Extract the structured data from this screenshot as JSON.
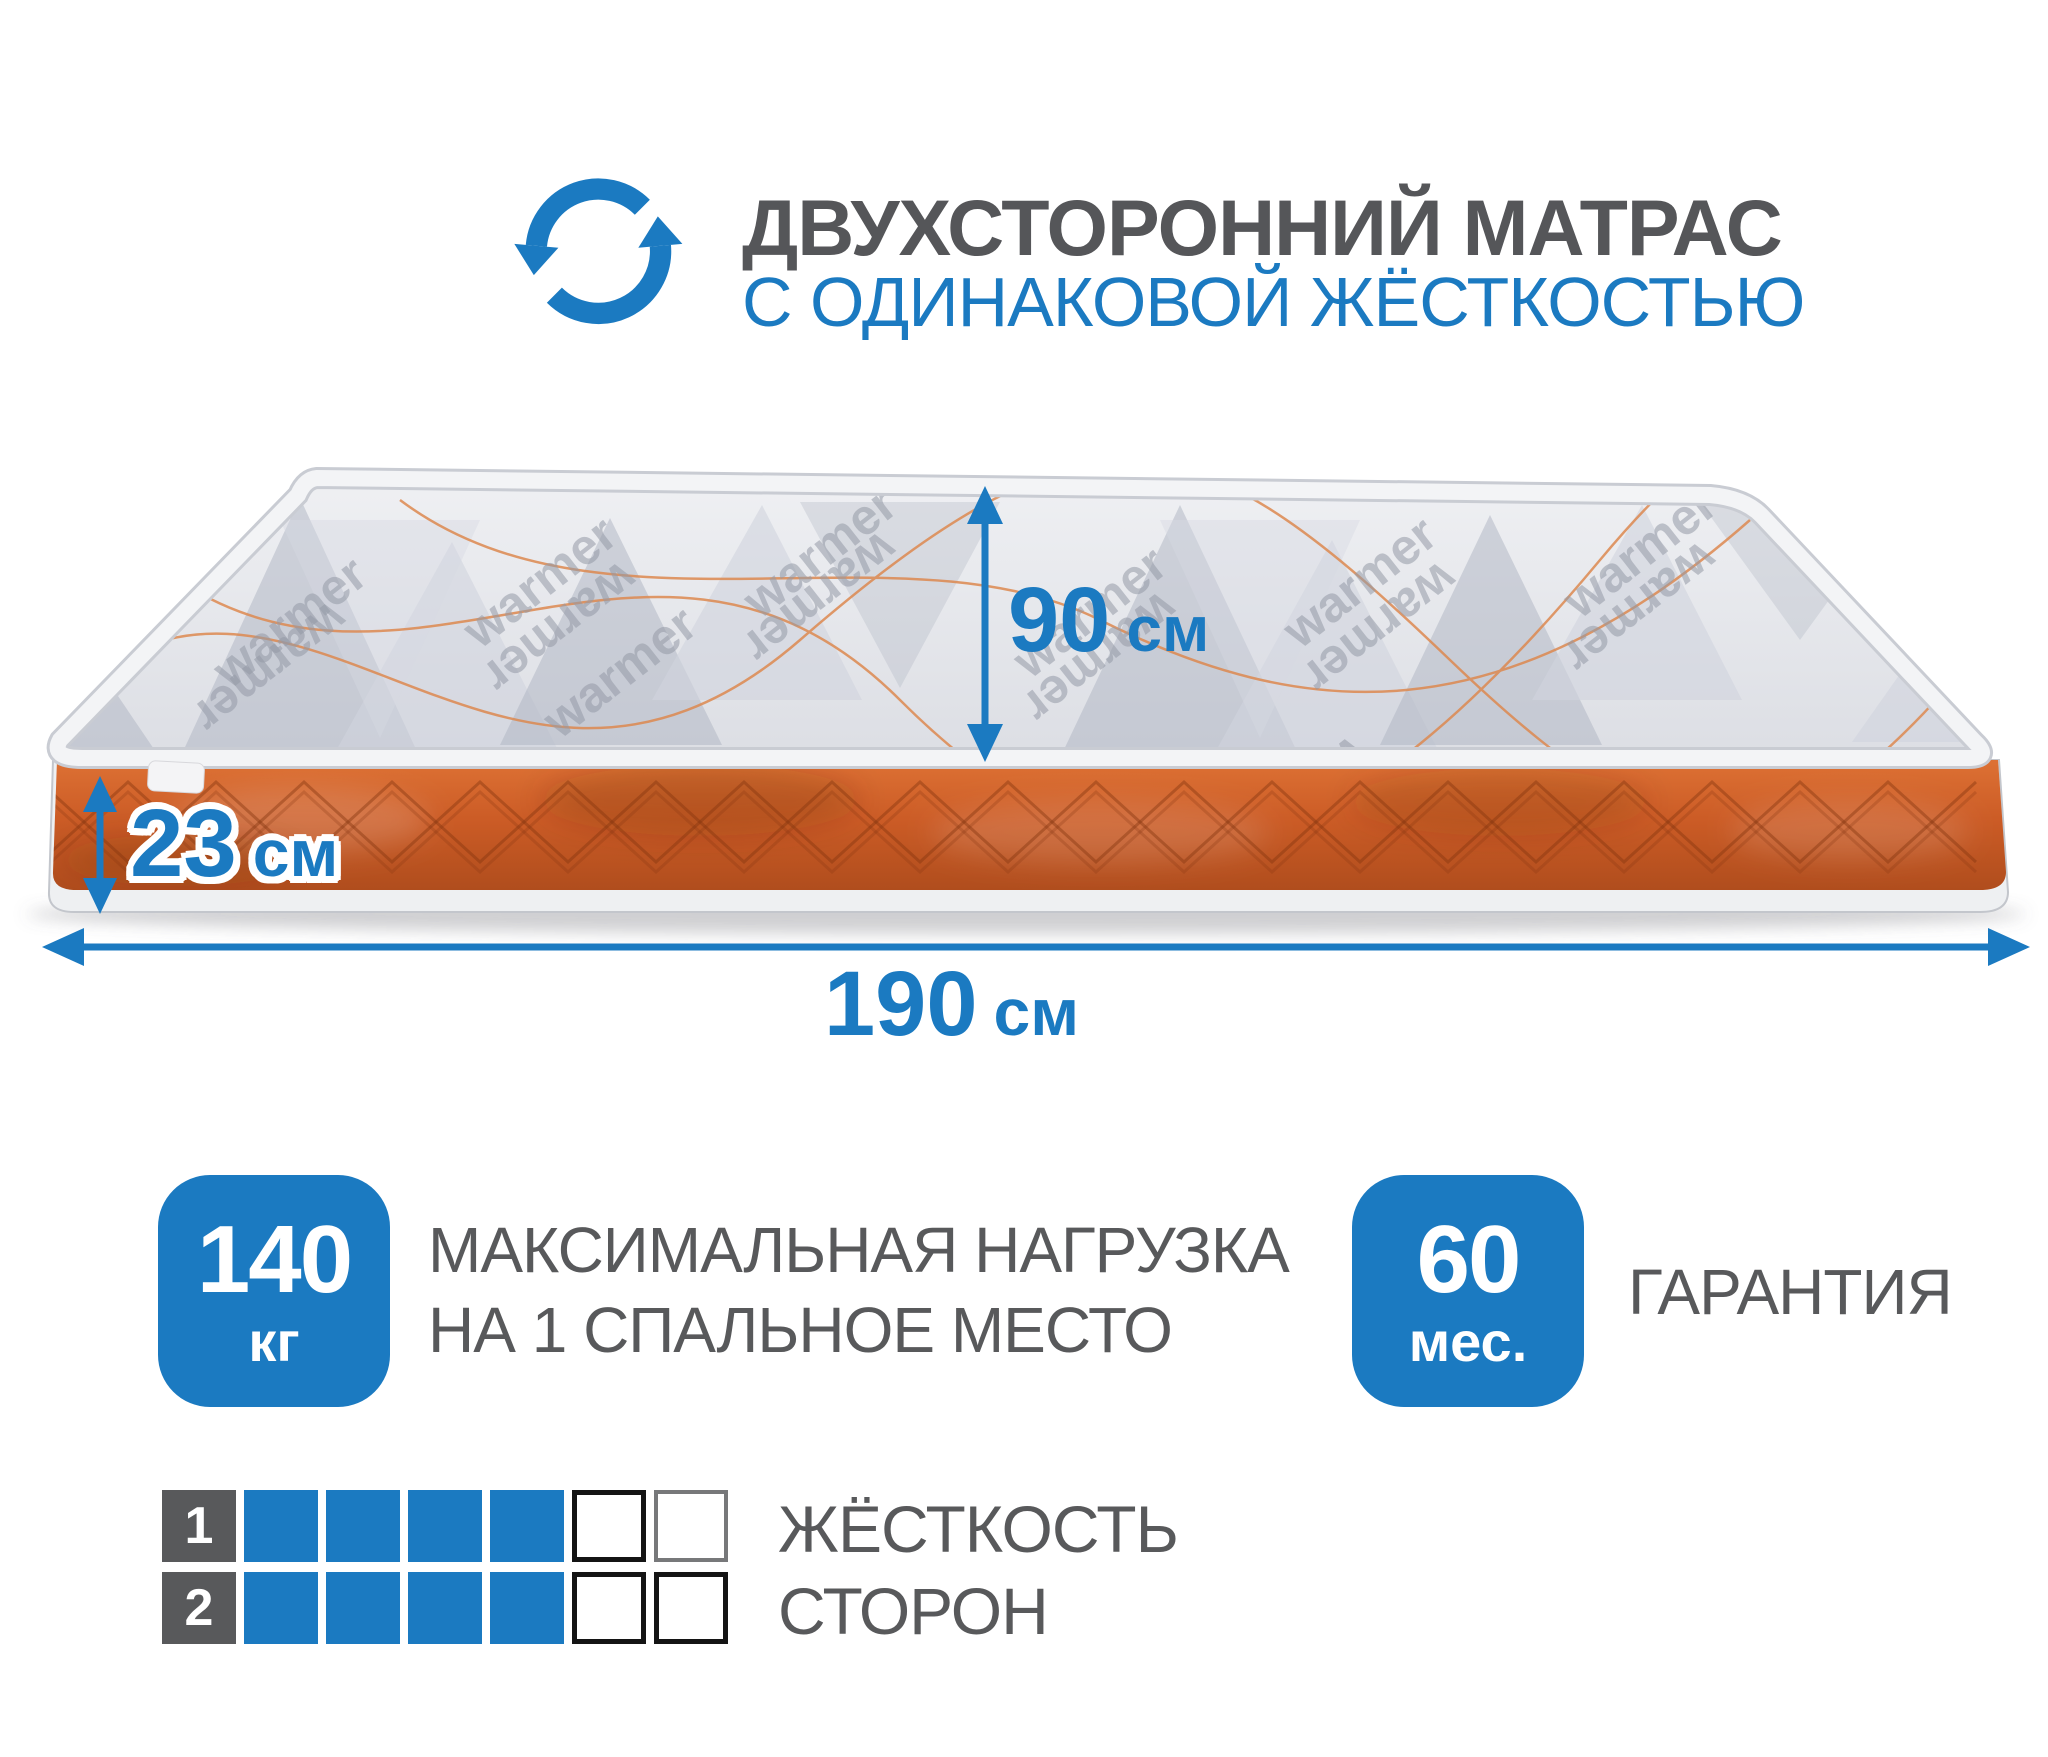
{
  "header": {
    "icon": "rotate-arrows-icon",
    "title_line1": "ДВУХСТОРОННИЙ МАТРАС",
    "title_line2": "С ОДИНАКОВОЙ ЖЁСТКОСТЬЮ"
  },
  "mattress": {
    "watermark": "warmer",
    "dimensions": {
      "width": {
        "value": "90",
        "unit": "см"
      },
      "thickness": {
        "value": "23",
        "unit": "см"
      },
      "length": {
        "value": "190",
        "unit": "см"
      }
    }
  },
  "features": {
    "max_load": {
      "value": "140",
      "unit": "кг",
      "label_line1": "МАКСИМАЛЬНАЯ НАГРУЗКА",
      "label_line2": "НА 1 СПАЛЬНОЕ МЕСТО"
    },
    "warranty": {
      "value": "60",
      "unit": "мес.",
      "label": "ГАРАНТИЯ"
    }
  },
  "hardness_scale": {
    "label_line1": "ЖЁСТКОСТЬ",
    "label_line2": "СТОРОН",
    "cells_total": 6,
    "rows": [
      {
        "number": "1",
        "filled": 4
      },
      {
        "number": "2",
        "filled": 4
      }
    ]
  },
  "colors": {
    "accent_blue": "#1b7ac1",
    "text_gray": "#58595b",
    "side_orange": "#cc5c26",
    "top_fabric_gray": "#e6e8ec"
  }
}
